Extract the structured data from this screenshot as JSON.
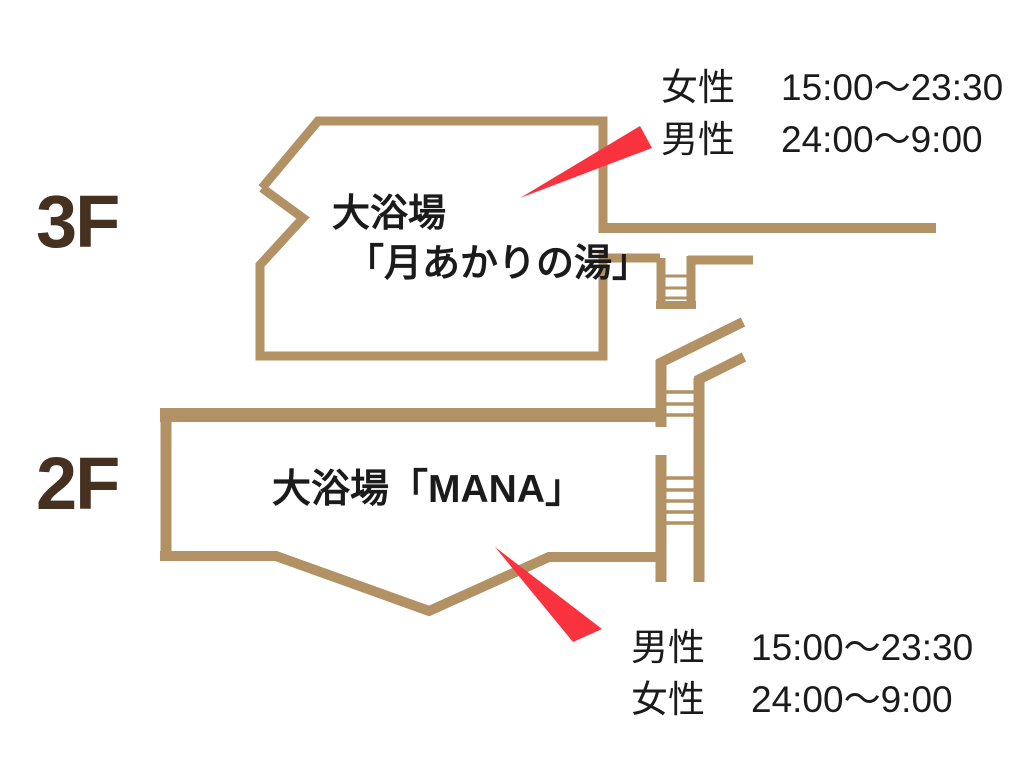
{
  "floors": [
    {
      "label": "3F",
      "bath_name_line1": "大浴場",
      "bath_name_line2": "「月あかりの湯」",
      "schedule": [
        {
          "gender": "女性",
          "time": "15:00〜23:30"
        },
        {
          "gender": "男性",
          "time": "24:00〜9:00"
        }
      ]
    },
    {
      "label": "2F",
      "bath_name_line1": "大浴場「MANA」",
      "schedule": [
        {
          "gender": "男性",
          "time": "15:00〜23:30"
        },
        {
          "gender": "女性",
          "time": "24:00〜9:00"
        }
      ]
    }
  ],
  "colors": {
    "wall": "#b29264",
    "arrow": "#f9333d",
    "text": "#1b1b1b",
    "floor_label": "#46301f",
    "background": "#ffffff"
  }
}
